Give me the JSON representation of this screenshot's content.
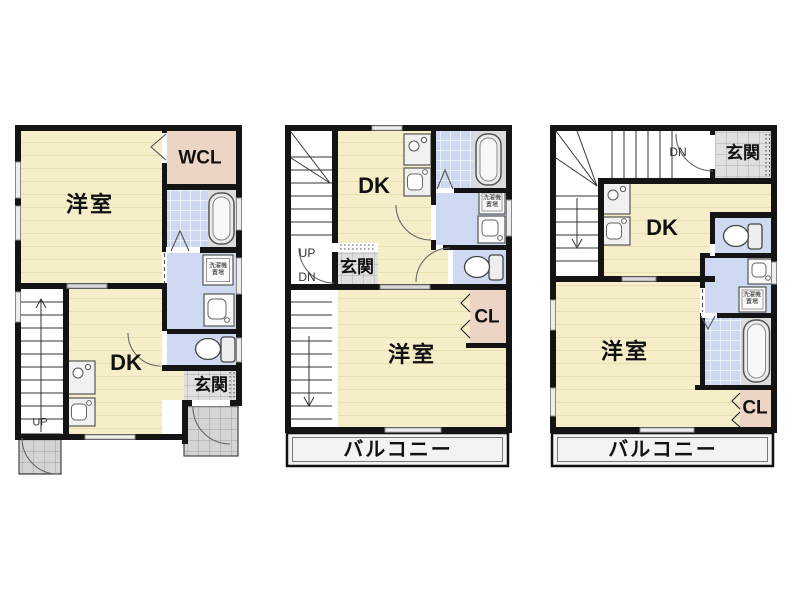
{
  "floors": [
    {
      "name": "floor-1",
      "labels": {
        "western_room": "洋室",
        "walk_in_closet": "WCL",
        "dining_kitchen": "DK",
        "entrance": "玄関",
        "stairs_up": "UP",
        "laundry_line1": "洗濯機",
        "laundry_line2": "置場"
      }
    },
    {
      "name": "floor-2",
      "labels": {
        "dining_kitchen": "DK",
        "entrance": "玄関",
        "stairs_up": "UP",
        "stairs_down": "DN",
        "western_room": "洋室",
        "closet": "CL",
        "balcony": "バルコニー",
        "laundry_line1": "洗濯機",
        "laundry_line2": "置場"
      }
    },
    {
      "name": "floor-3",
      "labels": {
        "stairs_down": "DN",
        "entrance": "玄関",
        "dining_kitchen": "DK",
        "western_room": "洋室",
        "closet": "CL",
        "balcony": "バルコニー",
        "laundry_line1": "洗濯機",
        "laundry_line2": "置場"
      }
    }
  ],
  "colors": {
    "wall": "#141414",
    "room_floor": "#f6eec9",
    "closet": "#ecd5c5",
    "wet_area": "#cfd9f1",
    "bath_tile": "#ccd7f0",
    "entrance_tile": "#e0e0e0",
    "balcony": "#f3f3f3"
  }
}
